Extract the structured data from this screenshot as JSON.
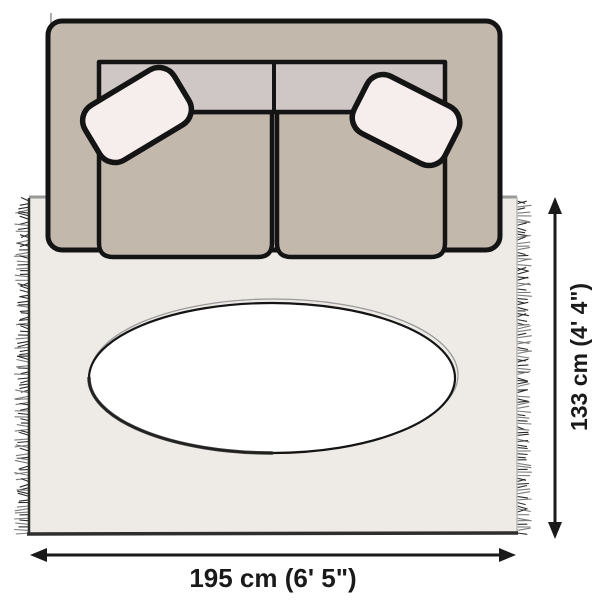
{
  "dimensions": {
    "width_label": "195 cm (6' 5\")",
    "height_label": "133 cm (4' 4\")"
  },
  "colors": {
    "background": "#ffffff",
    "rug": "#eeebe7",
    "rug_edge_top": "#9a9a9a",
    "rug_edge_side": "#bdbab6",
    "rug_edge_dark": "#2e2e2e",
    "fringe": "#2b2b2b",
    "fringe_light": "#7a7a7a",
    "sofa_body": "#c3b8ac",
    "sofa_backrest": "#cfc7c5",
    "pillow": "#f6eeec",
    "table": "#ffffff",
    "outline": "#141414",
    "annotation": "#1a1a1a"
  }
}
